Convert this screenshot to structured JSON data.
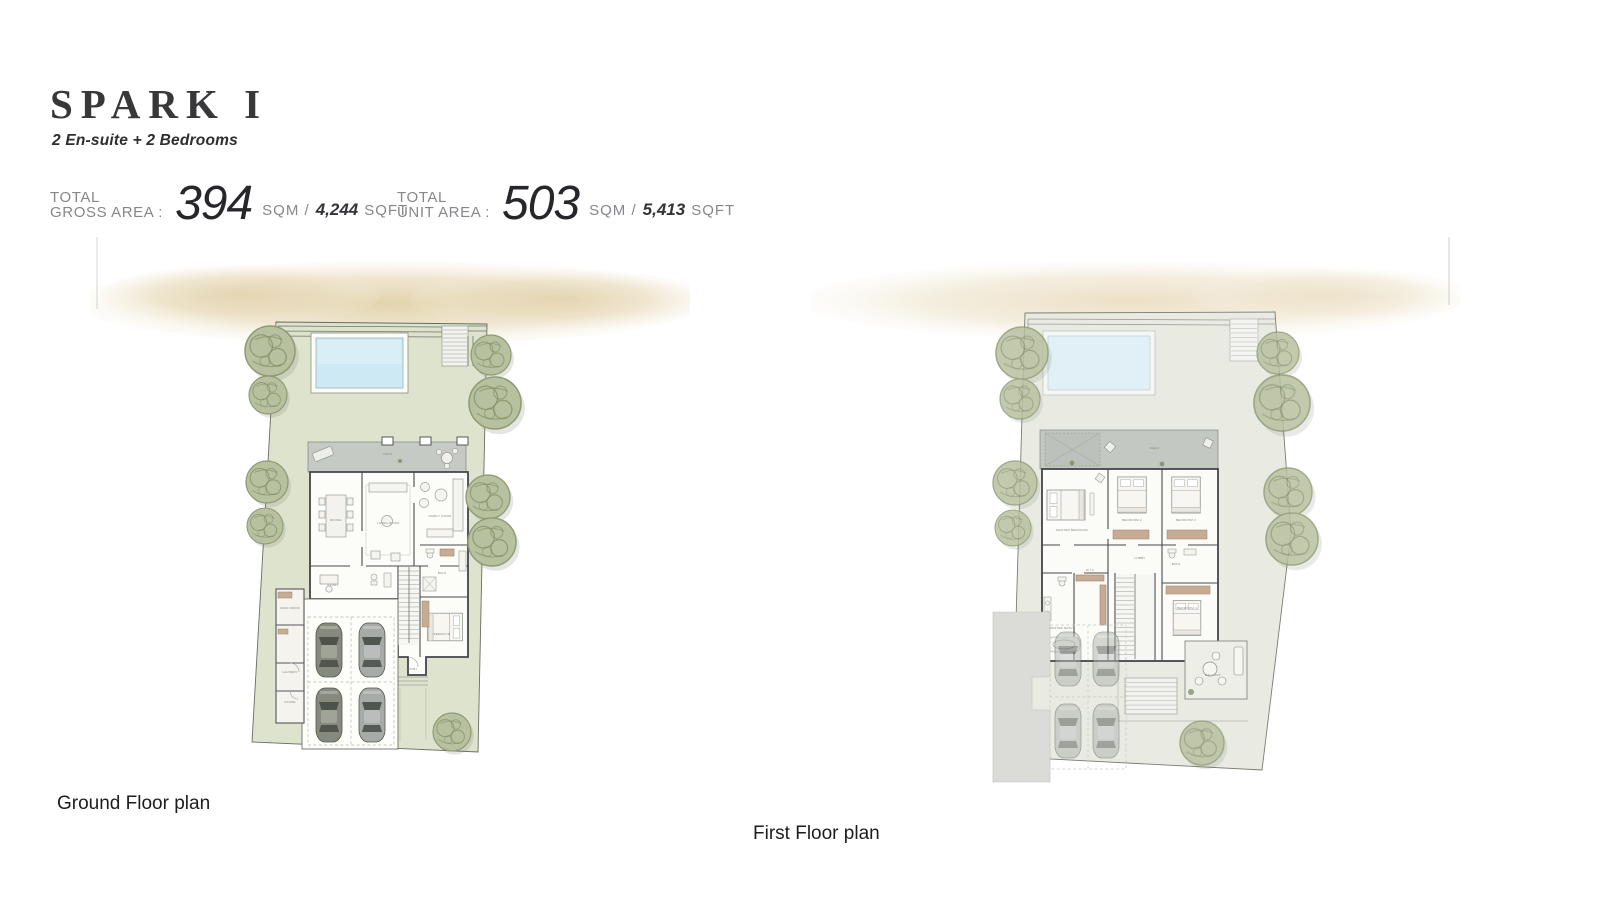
{
  "header": {
    "title": "SPARK I",
    "subtitle": "2 En-suite + 2 Bedrooms"
  },
  "stats": {
    "gross": {
      "label_line1": "TOTAL",
      "label_line2": "GROSS AREA :",
      "value": "394",
      "unit_sqm": "SQM /",
      "value_sqft": "4,244",
      "unit_sqft": "SQFT"
    },
    "unit": {
      "label_line1": "TOTAL",
      "label_line2": "UNIT AREA :",
      "value": "503",
      "unit_sqm": "SQM /",
      "value_sqft": "5,413",
      "unit_sqft": "SQFT"
    }
  },
  "plans": {
    "ground": {
      "caption": "Ground Floor plan",
      "rooms": {
        "deck": "DECK",
        "dining": "DINING",
        "living": "LIVING ROOM",
        "family": "FAMILY ROOM",
        "study": "STUDY",
        "bath": "BATH",
        "bedroom": "BEDROOM",
        "maid": "MAID ROOM",
        "laundry": "LAUNDRY",
        "store": "STORE",
        "entry": "ENTRY"
      }
    },
    "first": {
      "caption": "First Floor plan",
      "rooms": {
        "deck": "DECK",
        "master": "MASTER BEDROOM",
        "bedroom2": "BEDROOM 2",
        "bedroom3": "BEDROOM 3",
        "bedroom4": "BEDROOM 4",
        "masterbath": "MASTER BATH",
        "wic": "W.I.C",
        "bath": "BATH",
        "lobby": "LOBBY",
        "balcony": "BALCONY"
      }
    }
  },
  "colors": {
    "lawn": "#dde3cc",
    "plot_first": "#e9ebe2",
    "pool": "#cdeaf4",
    "pool_faded": "#e1eff6",
    "sand": "#e3d3ae",
    "terrace": "#c5cac4",
    "tree": "#b7c09f",
    "tree_stroke": "#8e9b74",
    "wall": "#44444a",
    "car_olive": "#868a7c",
    "car_gray": "#a7aba8",
    "car_ghost": "#b0b5b0",
    "wood_accent": "#c7ab95",
    "text_dark": "#2c2c30",
    "text_gray": "#85878a"
  }
}
